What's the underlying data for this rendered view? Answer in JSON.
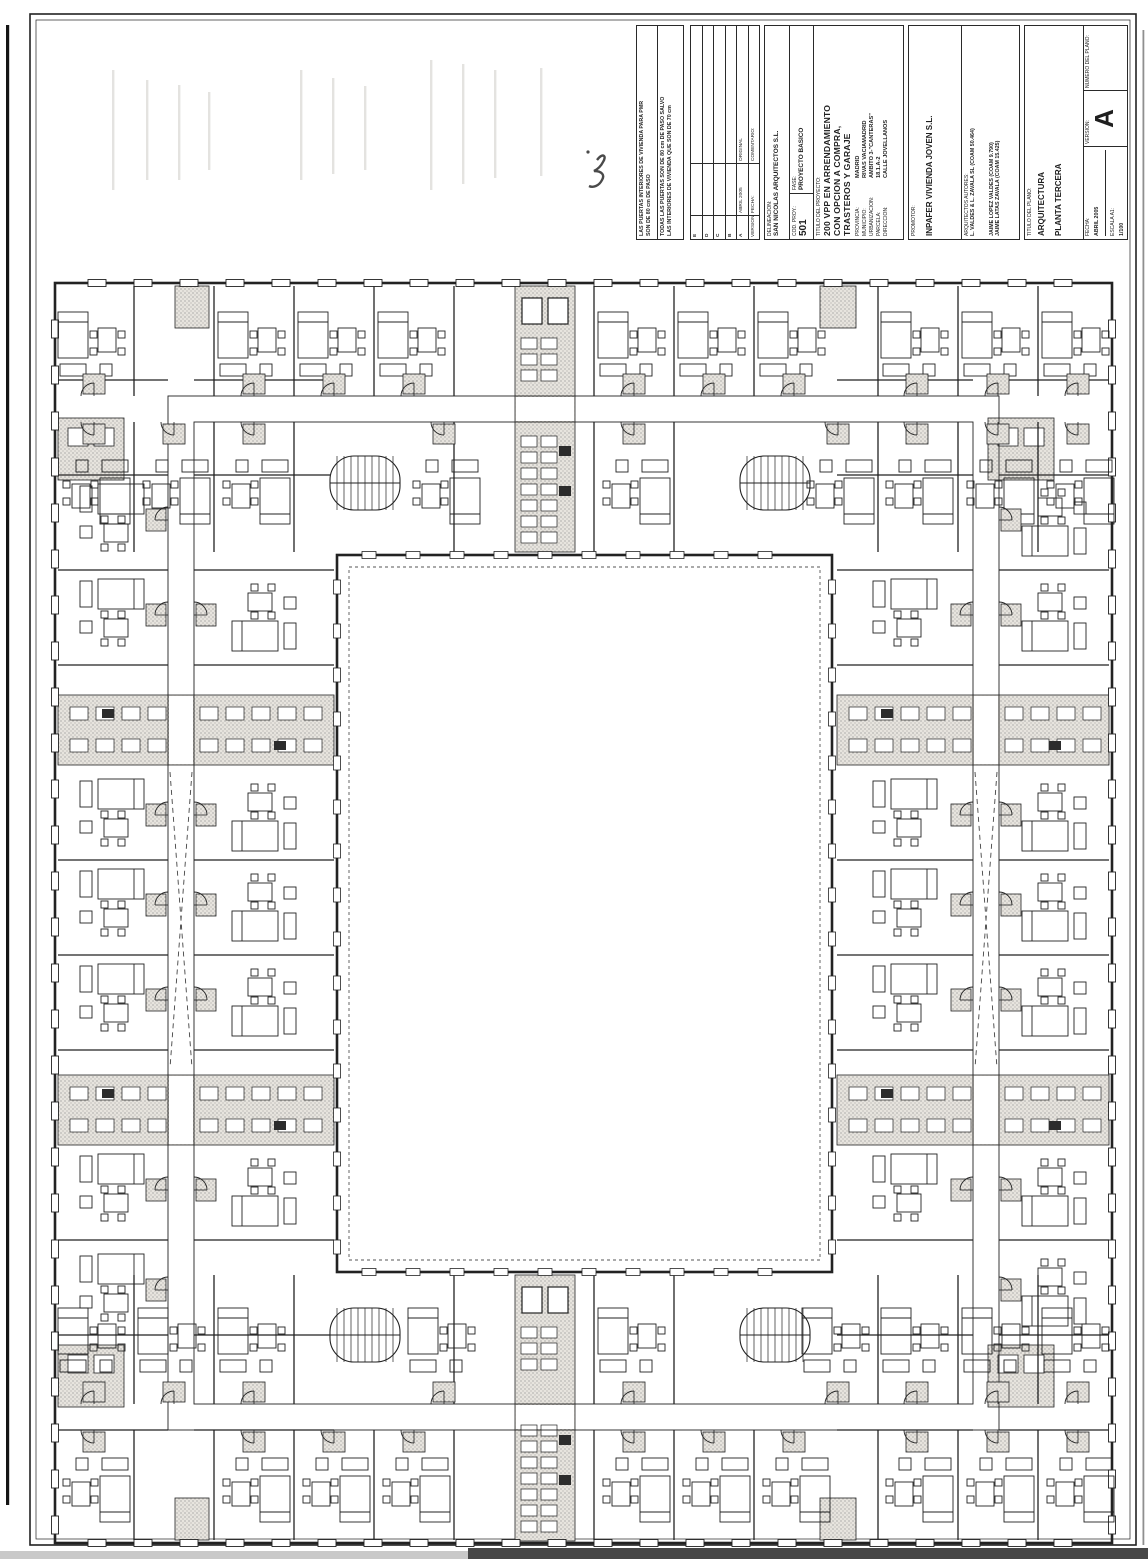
{
  "title_block": {
    "note_pmr_1": "LAS PUERTAS INTERIORES DE VIVIENDA PARA PMR",
    "note_pmr_2": "SON DE 80 cm DE PASO",
    "note_doors_1": "TODAS LAS PUERTAS SON DE 80 cm DE PASO SALVO",
    "note_doors_2": "LAS INTERIORES DE VIVIENDA QUE SON DE 70 cm",
    "revisions": {
      "header_version": "VERSION:",
      "header_fecha": "FECHA:",
      "header_comentario": "COMENTARIO:",
      "rows": [
        {
          "version": "E",
          "fecha": "",
          "comentario": ""
        },
        {
          "version": "D",
          "fecha": "",
          "comentario": ""
        },
        {
          "version": "C",
          "fecha": "",
          "comentario": ""
        },
        {
          "version": "B",
          "fecha": "",
          "comentario": ""
        },
        {
          "version": "A",
          "fecha": "ABRIL 2005",
          "comentario": "ORIGINAL"
        }
      ]
    },
    "delineacion_label": "DELINEACION:",
    "delineacion_value": "SAN NICOLAS ARQUITECTOS S.L.",
    "cod_proy_label": "COD. PROY.:",
    "cod_proy_value": "501",
    "fase_label": "FASE:",
    "fase_value": "PROYECTO BASICO",
    "titulo_proyecto_label": "TITULO DEL PROYECTO:",
    "titulo_proyecto_lines": [
      "200 VPP EN ARRENDAMIENTO",
      "CON OPCION A COMPRA,",
      "TRASTEROS Y GARAJE"
    ],
    "provincia_label": "PROVINCIA:",
    "provincia_value": "MADRID",
    "municipio_label": "MUNICIPIO:",
    "municipio_value": "RIVAS VACIAMADRID",
    "urbanizacion_label": "URBANIZACION:",
    "urbanizacion_value": "AMBITO 3-\"CANTERAS\"",
    "parcela_label": "PARCELA:",
    "parcela_value": "18.1.A-2",
    "direccion_label": "DIRECCION:",
    "direccion_value": "CALLE JOVELLANOS",
    "promotor_label": "PROMOTOR:",
    "promotor_value": "INPAFER VIVIENDA JOVEN S.L.",
    "arquitectos_label": "ARQUITECTOS AUTORES:",
    "arquitectos_line1": "L. VALDES & L. ZAVALA SL (COAM 50.464)",
    "arquitectos_line2": "JAIME LOPEZ VALDES (COAM 9.790)",
    "arquitectos_line3": "JAIME LATAS ZAVALA (COAM 15.425)",
    "titulo_plano_label": "TITULO DEL PLANO:",
    "titulo_plano_line1": "ARQUITECTURA",
    "titulo_plano_line2": "PLANTA TERCERA",
    "fecha_label": "FECHA:",
    "fecha_value": "ABRIL 2005",
    "escala_label": "ESCALA A1:",
    "escala_value": "1/100",
    "version_label": "VERSION:",
    "version_value": "A",
    "numero_plano_label": "NUMERO DEL PLANO:"
  },
  "colors": {
    "ink": "#222222",
    "paper": "#ffffff",
    "stipple_bg": "#e7e4de",
    "stipple_dot": "#8a8a8a",
    "scan_dark": "#474747",
    "scan_light": "#c9c9c9",
    "ghost": "#b9b6b0",
    "pencil": "#4a4a4a"
  }
}
